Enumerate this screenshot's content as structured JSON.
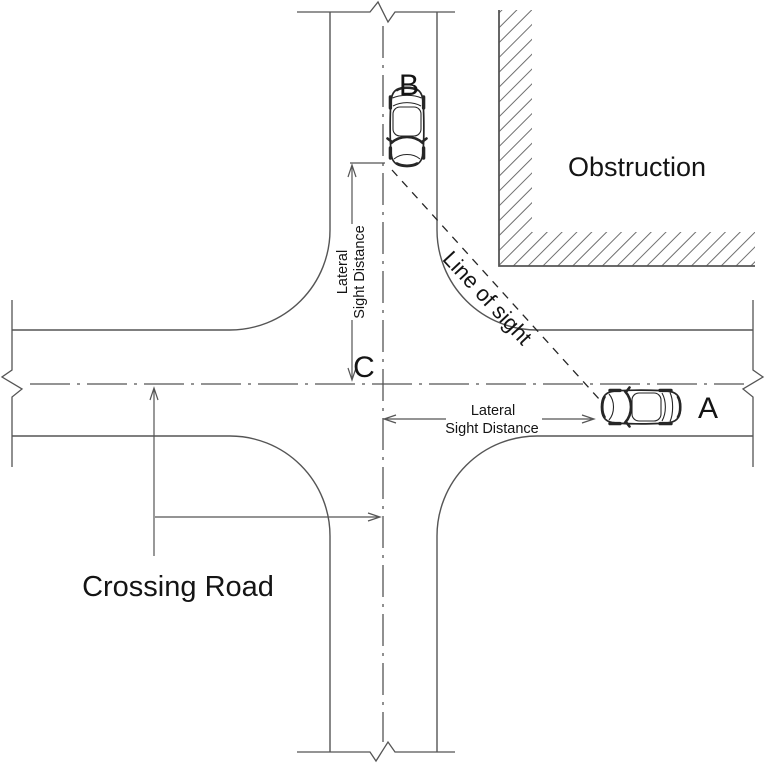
{
  "colors": {
    "background": "#ffffff",
    "line": "#555555",
    "vehicle": "#262626",
    "text": "#141414",
    "hatch": "#6f6f6f"
  },
  "labels": {
    "obstruction": "Obstruction",
    "line_of_sight": "Line of sight",
    "lateral_line1": "Lateral",
    "lateral_line2": "Sight Distance",
    "crossing_road": "Crossing Road",
    "vehicle_a": "A",
    "vehicle_b": "B",
    "point_c": "C"
  }
}
